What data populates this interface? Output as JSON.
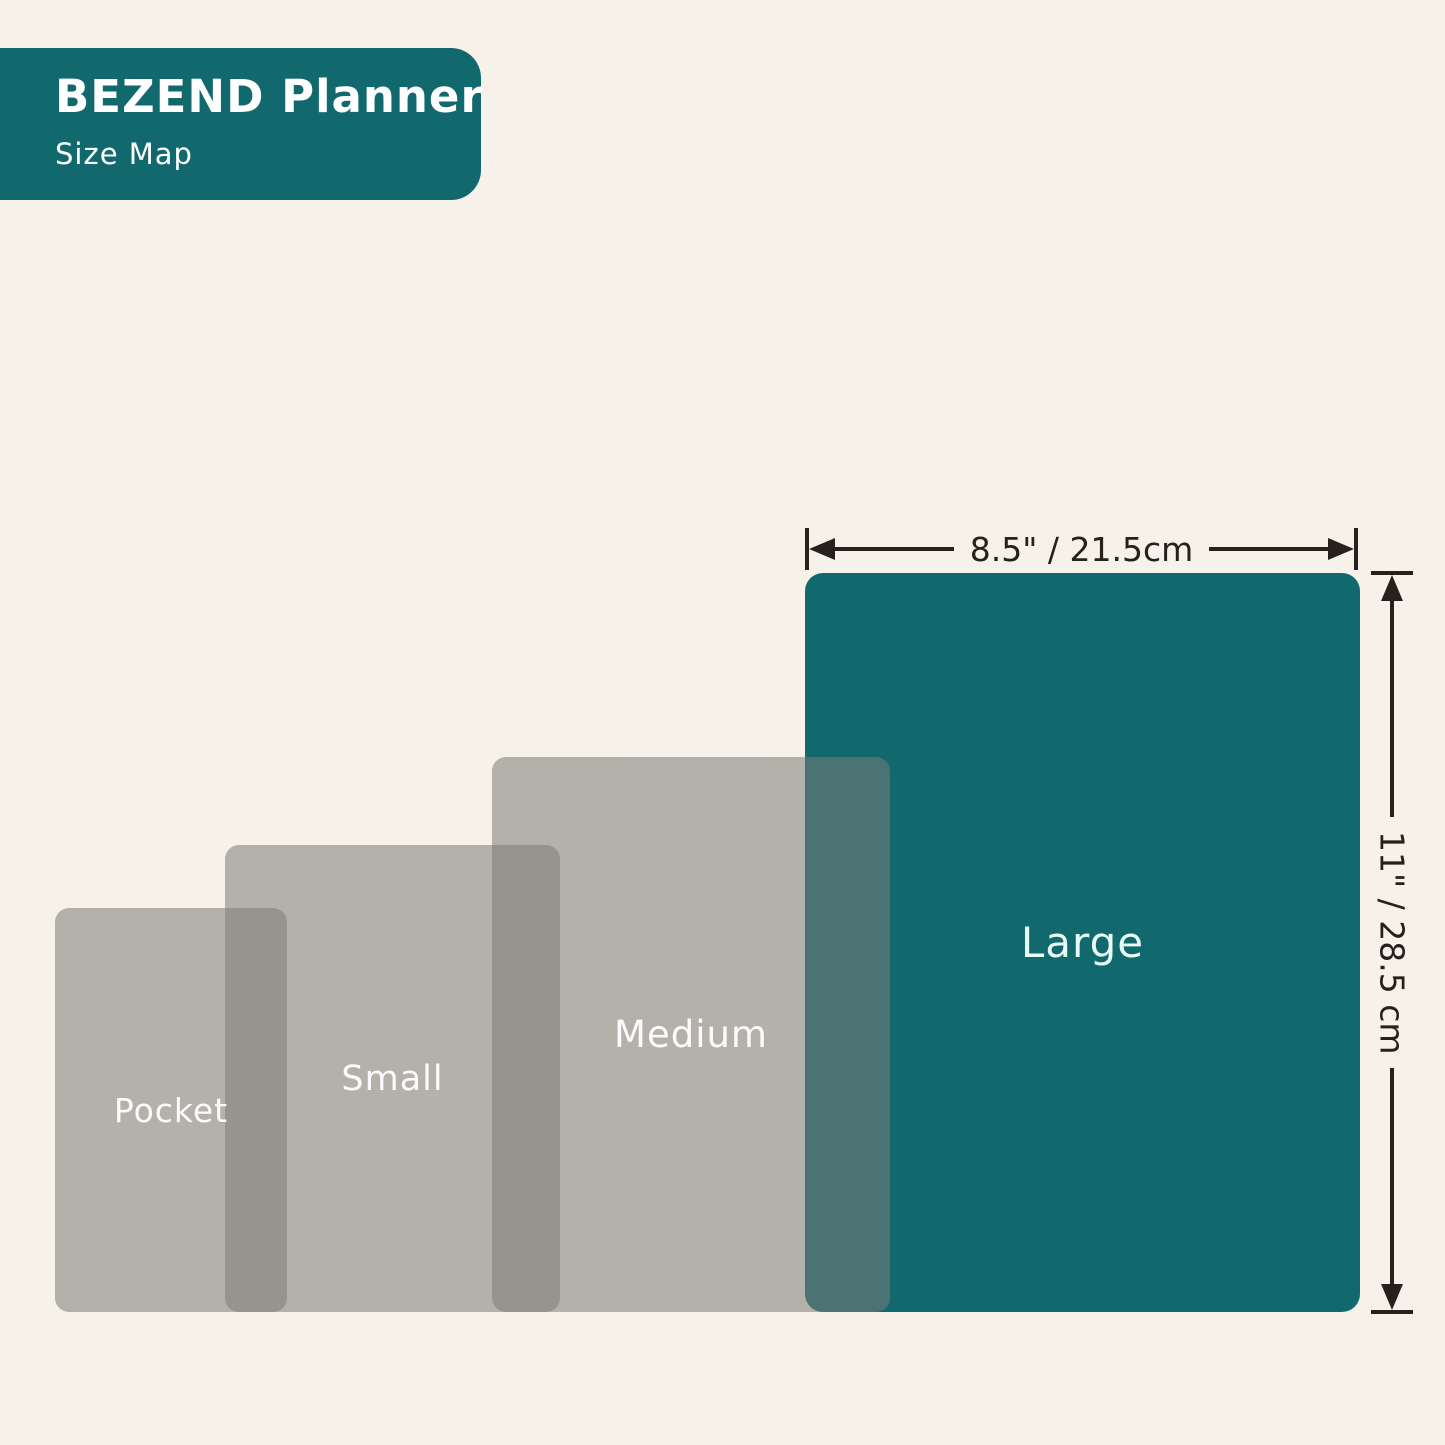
{
  "header": {
    "title": "BEZEND Planner",
    "subtitle": "Size Map"
  },
  "sizes": [
    {
      "id": "pocket",
      "label": "Pocket"
    },
    {
      "id": "small",
      "label": "Small"
    },
    {
      "id": "medium",
      "label": "Medium"
    },
    {
      "id": "large",
      "label": "Large"
    }
  ],
  "dimensions": {
    "width_label": "8.5\" / 21.5cm",
    "height_label": "11\" / 28.5 cm"
  },
  "colors": {
    "teal": "#11696E",
    "background": "#F6F2E9",
    "gray_overlay": "rgba(125,123,121,0.55)",
    "dimension_line": "#26211C",
    "large_label_text": "#E9FBF5",
    "label_text": "#FBFBFB"
  }
}
